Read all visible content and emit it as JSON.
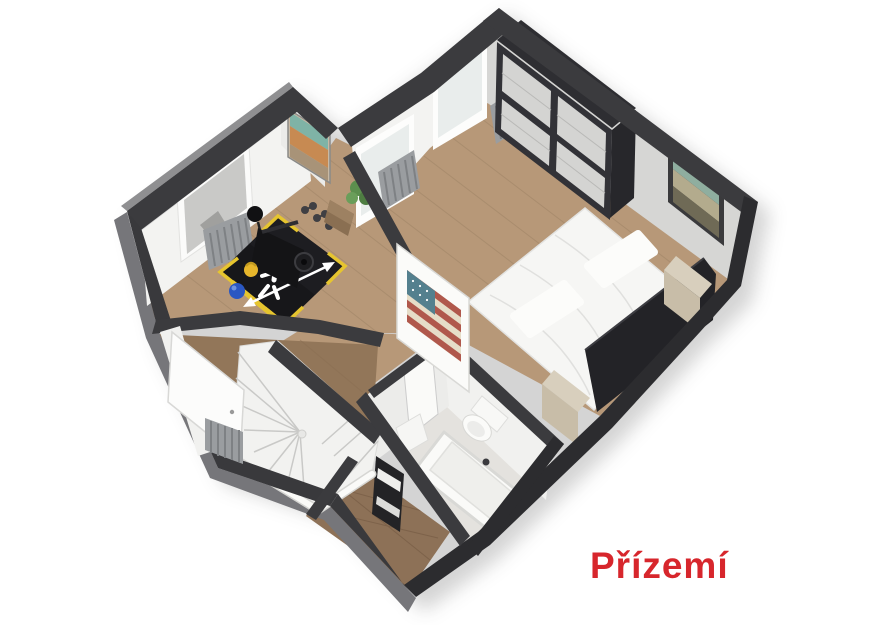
{
  "label": {
    "text": "Přízemí",
    "color": "#d7262c"
  },
  "colors": {
    "background": "#ffffff",
    "wall": "#3b3b3e",
    "wall_cut_dark": "#2c2c2f",
    "wall_outer_side": "#76767a",
    "wall_face_white": "#f3f3f1",
    "wall_face_gray": "#d6d6d4",
    "floor_wood": "#b79878",
    "floor_wood_dark": "#927659",
    "floor_bathroom": "#e4e2de",
    "gym_mat": "#17171a",
    "mat_accent_yellow": "#e6c52f",
    "wardrobe_dark": "#323237",
    "wardrobe_door": "#d4d4d2",
    "bed_white": "#f6f6f4",
    "headboard": "#232327",
    "nightstand": "#d8cfbd",
    "radiator": "#9a9da0",
    "stairs": "#f2f2f0",
    "ball_blue": "#2a57c2",
    "kettlebell_yellow": "#e7b62c",
    "flag_red": "#b0584c",
    "flag_cream": "#e6ddc8",
    "flag_canton": "#54808e",
    "painting_teal": "#8fae9f",
    "mirror_teal": "#7fb3a6",
    "mirror_orange": "#c78a52",
    "plant_green": "#4e7d42"
  }
}
